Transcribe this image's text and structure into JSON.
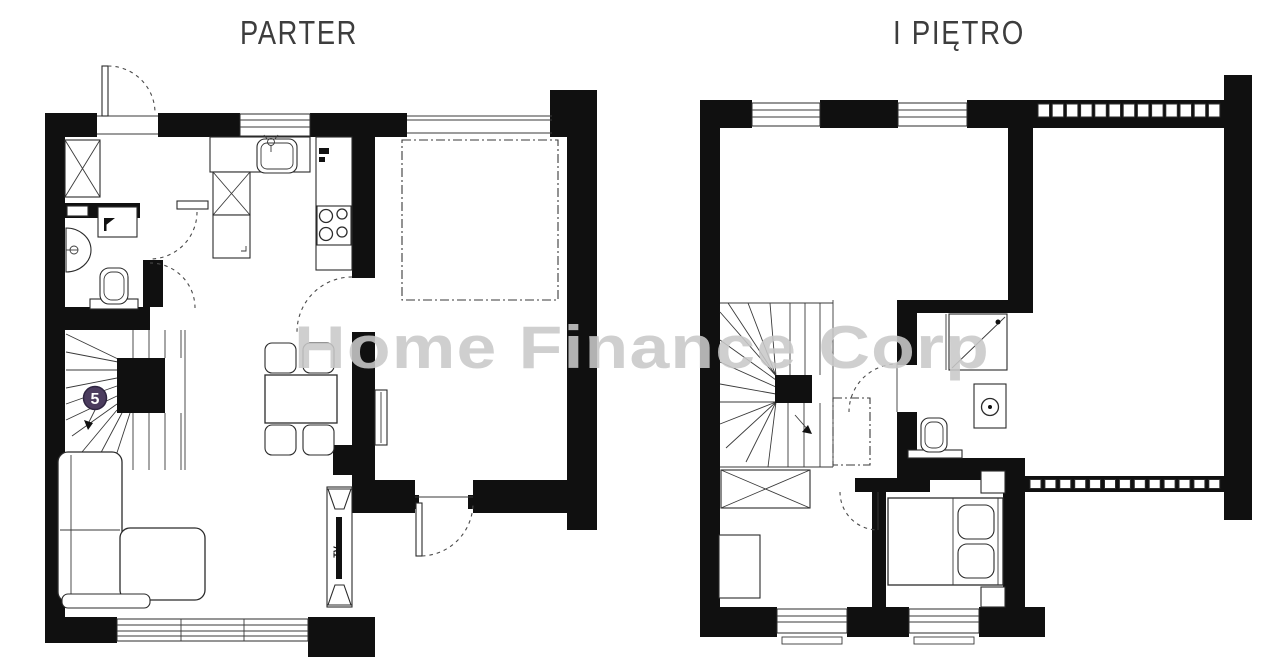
{
  "watermark": {
    "text": "Home Finance Corp",
    "color": "#c9c9c9"
  },
  "ground_floor": {
    "title": "PARTER",
    "stairs_badge": "5",
    "tv_label": "TV"
  },
  "first_floor": {
    "title": "I PIĘTRO"
  },
  "colors": {
    "background": "#ffffff",
    "wall": "#101010",
    "line": "#2b2b2b",
    "door_arc": "#4a4a4a",
    "badge_fill": "#4b3c5e",
    "badge_text": "#ffffff",
    "title_text": "#3d3d3d",
    "watermark": "#c9c9c9"
  }
}
